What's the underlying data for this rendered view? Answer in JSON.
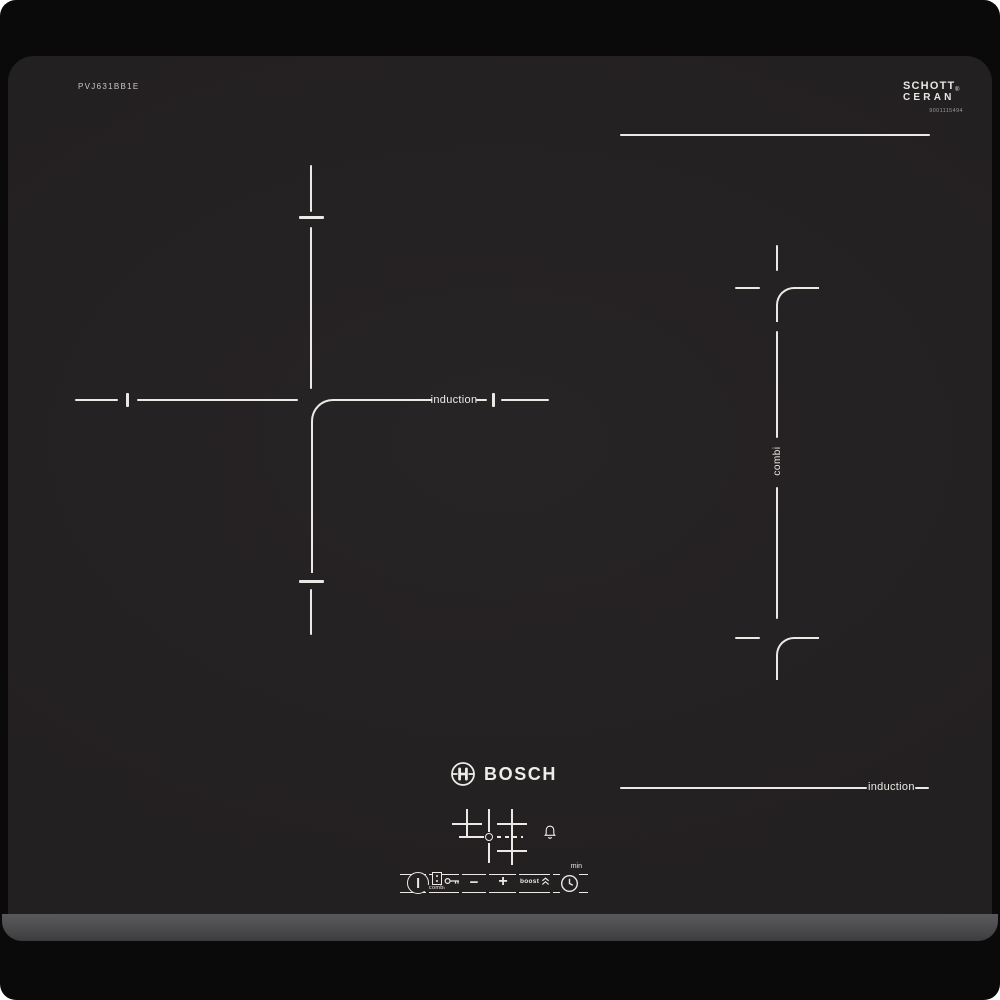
{
  "photo": {
    "background_color": "#ffffff"
  },
  "hob": {
    "model_number": "PVJ631BB1E",
    "brand_logo_text": "BOSCH",
    "glass_brand": {
      "line1": "SCHOTT",
      "line2": "CERAN",
      "registered_mark": "®",
      "code": "9001115494"
    },
    "zone_labels": {
      "left_zone": "induction",
      "right_zone": "combi",
      "bottom_right_zone": "induction"
    },
    "control_panel": {
      "combi_key_label": "combi",
      "minus_label": "−",
      "plus_label": "+",
      "boost_label": "boost",
      "timer_minutes_label": "min"
    },
    "colors": {
      "backdrop": "#0a0a0a",
      "glass": "#242122",
      "front_trim": "#4b4b4e",
      "markings": "#ece9e5"
    }
  }
}
